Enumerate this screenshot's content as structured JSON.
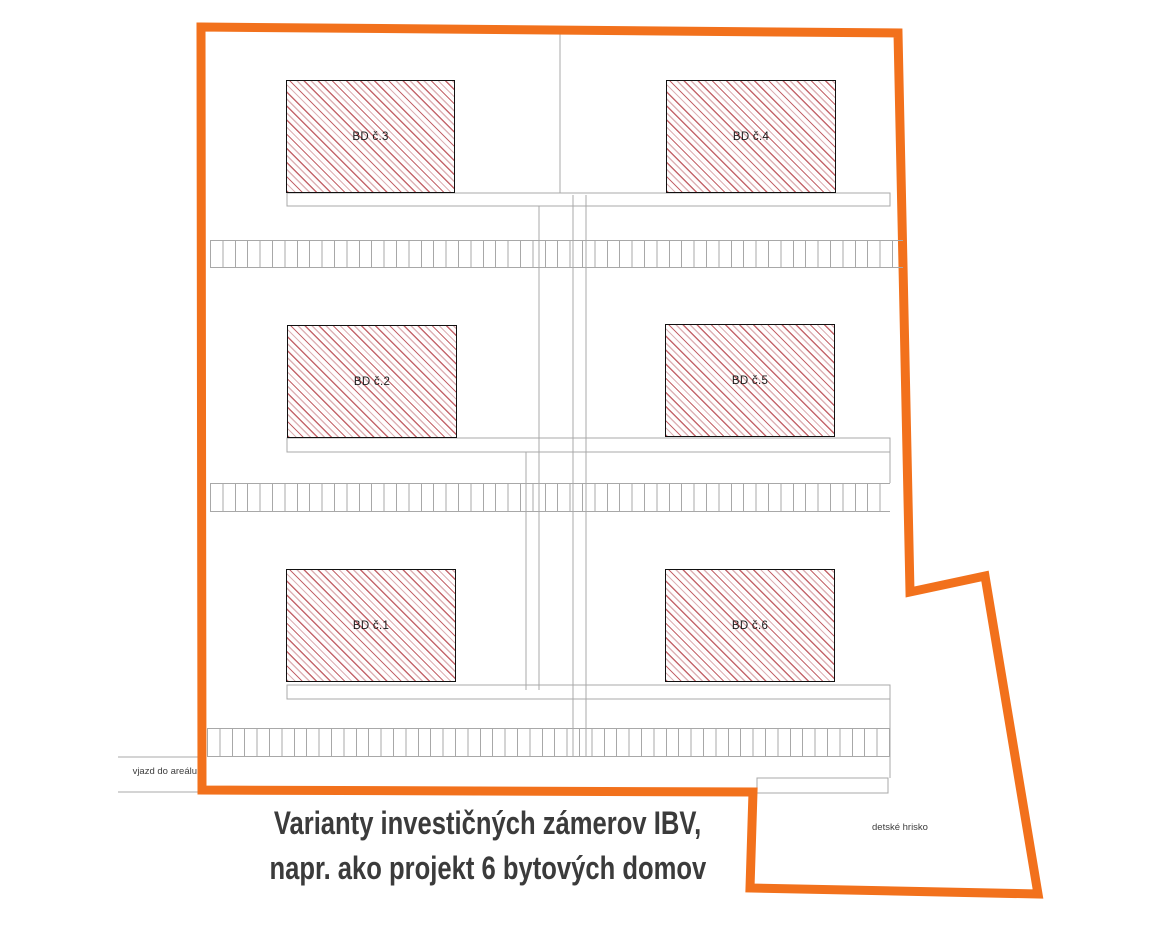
{
  "caption": {
    "line1": "Varianty investičných zámerov IBV,",
    "line2": "napr. ako projekt 6 bytových domov"
  },
  "site": {
    "buildings": [
      {
        "id": "bd1",
        "label": "BD č.1"
      },
      {
        "id": "bd2",
        "label": "BD č.2"
      },
      {
        "id": "bd3",
        "label": "BD č.3"
      },
      {
        "id": "bd4",
        "label": "BD č.4"
      },
      {
        "id": "bd5",
        "label": "BD č.5"
      },
      {
        "id": "bd6",
        "label": "BD č.6"
      }
    ],
    "annotations": {
      "entrance": "vjazd do areálu",
      "playground": "detské hrisko"
    }
  },
  "colors": {
    "boundary_orange": "#F2711C",
    "road_line_gray": "#A8A8A8",
    "hatch_red": "#C4666C",
    "hatch_light_pink": "#DDB2B6",
    "building_border": "#111111",
    "caption_text": "#3B3B3B"
  }
}
